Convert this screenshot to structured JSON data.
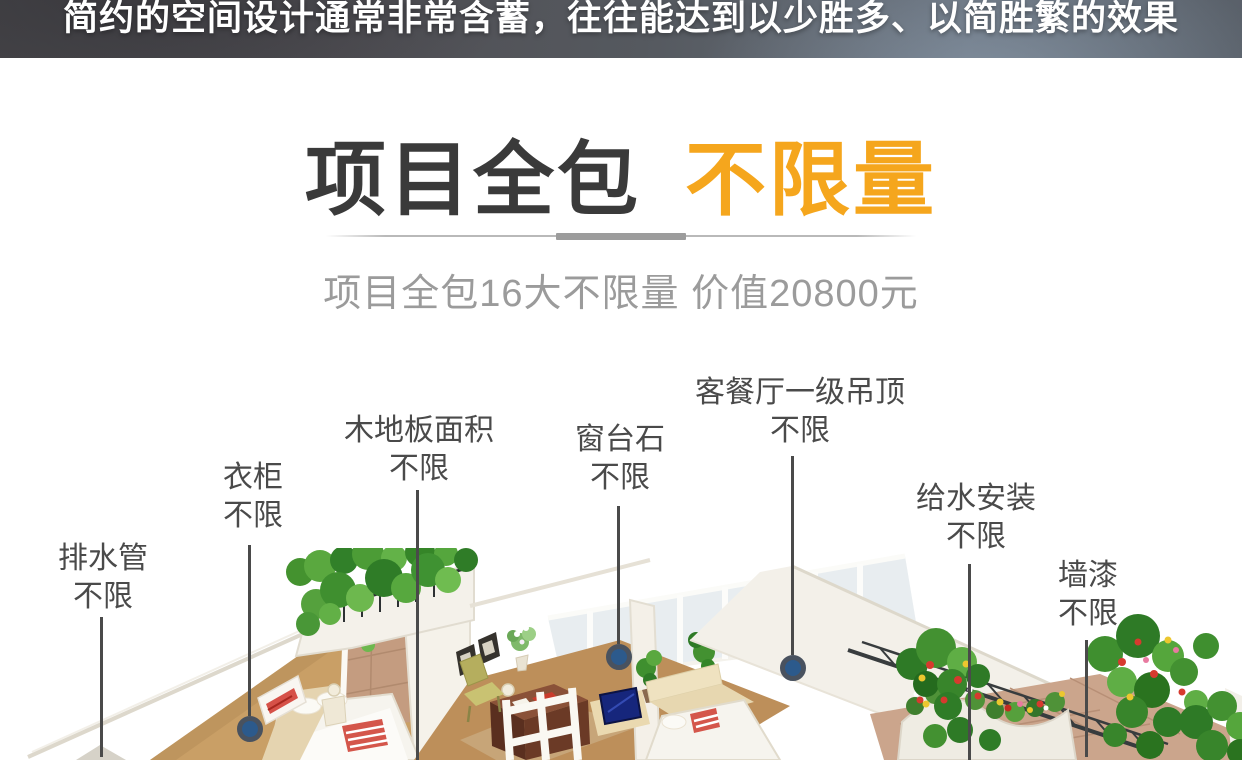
{
  "banner": {
    "text": "简约的空间设计通常非常含蓄，往往能达到以少胜多、以简胜繁的效果"
  },
  "heading": {
    "title_main": "项目全包",
    "title_accent": "不限量"
  },
  "subheading": "项目全包16大不限量 价值20800元",
  "callouts": [
    {
      "label": "排水管",
      "value": "不限"
    },
    {
      "label": "衣柜",
      "value": "不限"
    },
    {
      "label": "木地板面积",
      "value": "不限"
    },
    {
      "label": "窗台石",
      "value": "不限"
    },
    {
      "label": "客餐厅一级吊顶",
      "value": "不限"
    },
    {
      "label": "给水安装",
      "value": "不限"
    },
    {
      "label": "墙漆",
      "value": "不限"
    }
  ],
  "colors": {
    "accent_orange": "#F5A61D",
    "title_dark": "#3A3A3A",
    "subtitle_gray": "#9B9B9B",
    "label_gray": "#4A4A4A",
    "connector_line": "#4A4A4A",
    "connector_dot_fill": "#2C5A8C",
    "connector_dot_ring": "#49525F",
    "banner_background": "#55595F",
    "banner_text": "#FFFFFF"
  },
  "illustration": {
    "type": "isometric-apartment-3d-rendering"
  }
}
